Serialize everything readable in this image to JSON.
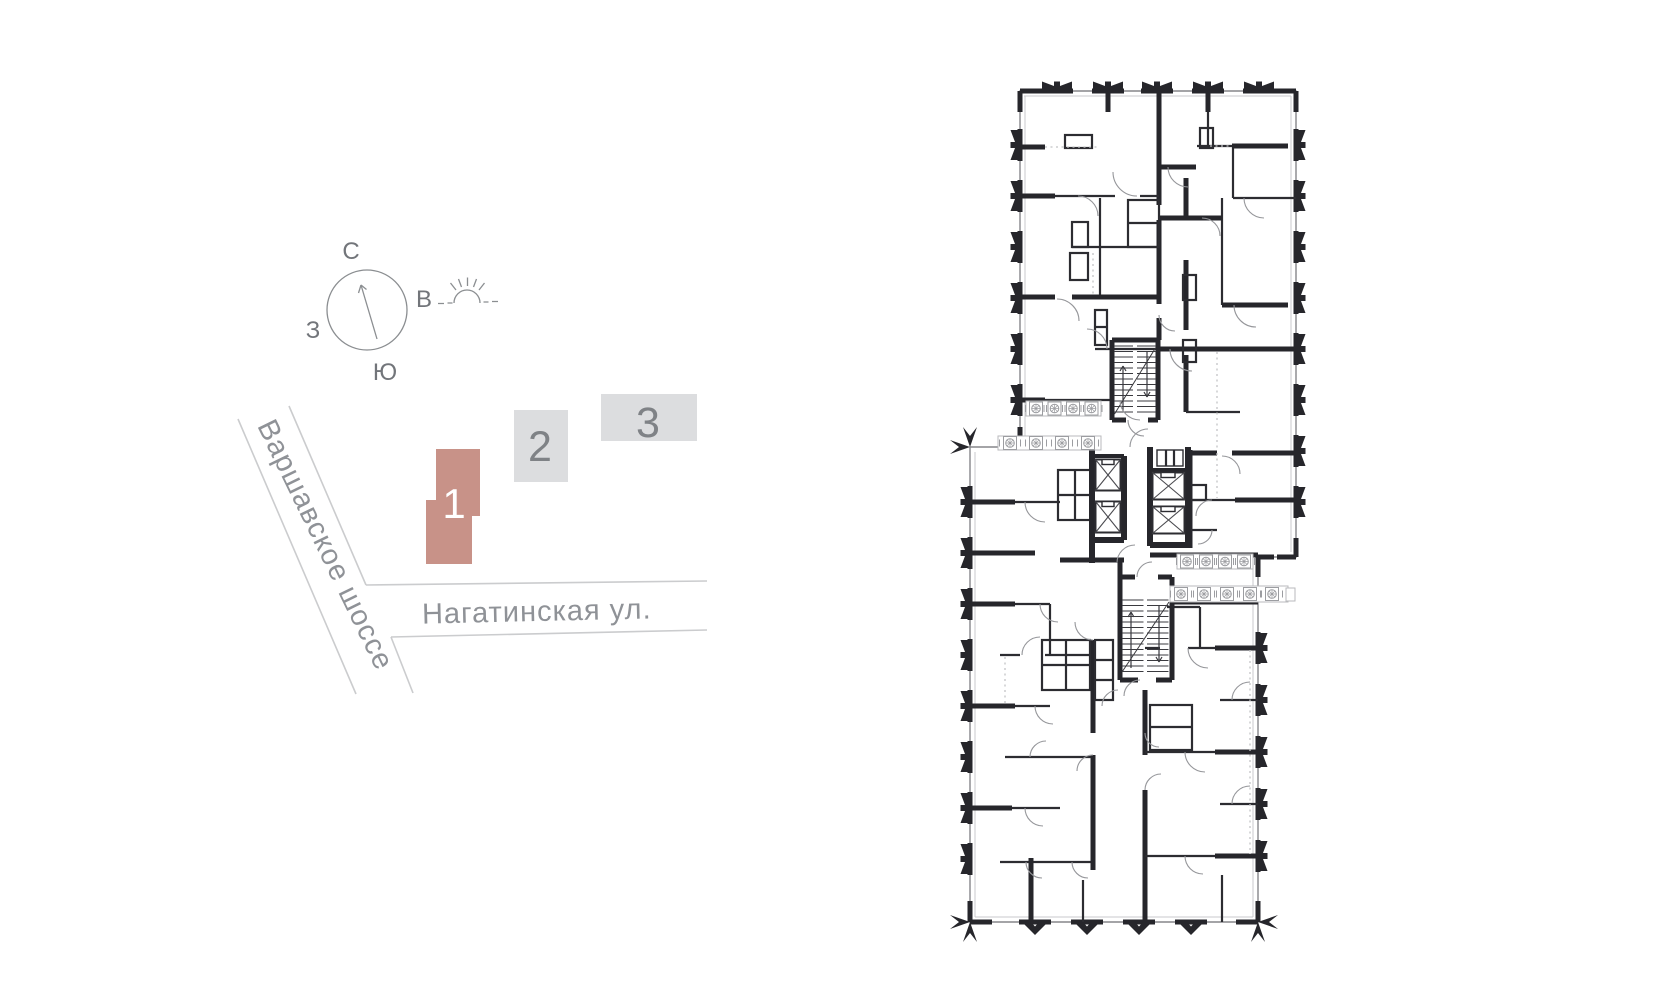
{
  "site_map": {
    "compass": {
      "north_label": "С",
      "east_label": "В",
      "south_label": "Ю",
      "west_label": "З"
    },
    "street_diagonal": "Варшавское шоссе",
    "street_horizontal": "Нагатинская ул.",
    "buildings": [
      {
        "number": "1",
        "selected": true
      },
      {
        "number": "2",
        "selected": false
      },
      {
        "number": "3",
        "selected": false
      }
    ]
  },
  "floor_plan": {
    "staircase_count": 2,
    "elevator_shaft_count": 4,
    "ac_unit_strip_count": 4
  },
  "colors": {
    "selected_building_fill": "#c89288",
    "building_fill": "#dcdddf",
    "building_number": "#7f8286",
    "selected_building_number": "#ffffff",
    "street_line": "#cbccce",
    "street_label_text": "#8f9297",
    "compass_text": "#72757a",
    "plan_wall": "#26262b",
    "plan_light_line": "#9b9ca0"
  }
}
